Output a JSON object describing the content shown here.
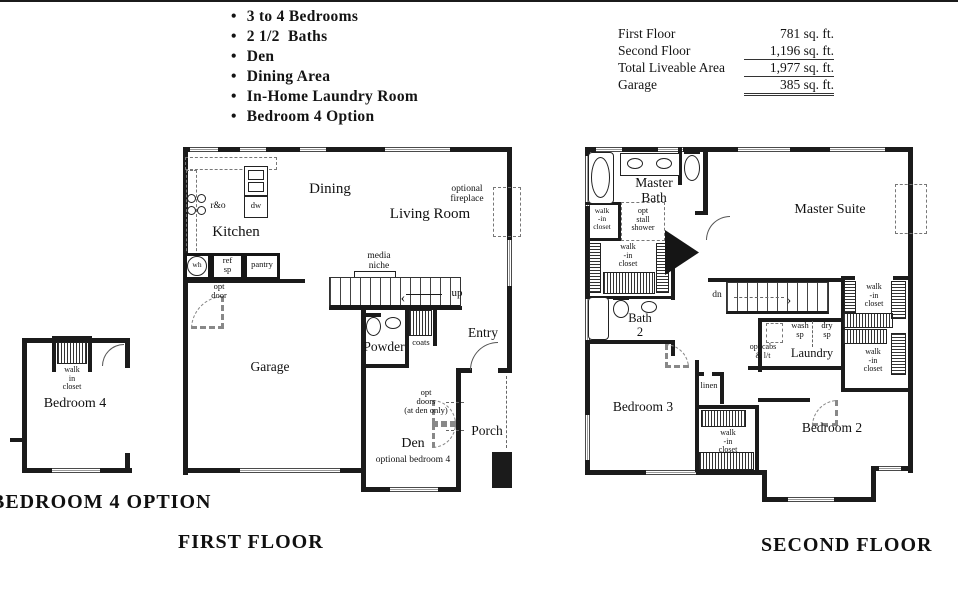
{
  "features": {
    "items": [
      "3 to 4 Bedrooms",
      "2 1/2  Baths",
      "Den",
      "Dining Area",
      "In-Home Laundry Room",
      "Bedroom 4 Option"
    ]
  },
  "area_table": {
    "rows": [
      {
        "label": "First Floor",
        "value": "781 sq. ft."
      },
      {
        "label": "Second Floor",
        "value": "1,196 sq. ft."
      },
      {
        "label": "Total Liveable Area",
        "value": "1,977 sq. ft."
      },
      {
        "label": "Garage",
        "value": "385 sq. ft."
      }
    ]
  },
  "first_floor": {
    "caption": "FIRST FLOOR",
    "labels": {
      "kitchen": "Kitchen",
      "dining": "Dining",
      "living_room": "Living Room",
      "optional_fireplace": "optional\nfireplace",
      "media_niche": "media\nniche",
      "up": "up",
      "powder": "Powder",
      "coats": "coats",
      "entry": "Entry",
      "garage": "Garage",
      "opt_door": "opt\ndoor",
      "opt_doors": "opt\ndoors\n(at den only)",
      "den": "Den",
      "den_sub": "optional bedroom 4",
      "porch": "Porch",
      "r_and_o": "r&o",
      "dw": "dw",
      "wh": "wh",
      "ref_sp": "ref\nsp",
      "pantry": "pantry"
    }
  },
  "bedroom4_option": {
    "caption": "BEDROOM 4 OPTION",
    "labels": {
      "room": "Bedroom 4",
      "closet": "walk\nin\ncloset"
    }
  },
  "second_floor": {
    "caption": "SECOND FLOOR",
    "labels": {
      "master_bath": "Master\nBath",
      "master_suite": "Master Suite",
      "opt_stall_shower": "opt\nstall\nshower",
      "walk_in_closet": "walk\n-in\ncloset",
      "bath_2": "Bath\n2",
      "dn": "dn",
      "wash_sp": "wash\nsp",
      "dry_sp": "dry\nsp",
      "opt_cabs": "opt cabs\n& l/t",
      "laundry": "Laundry",
      "linen": "linen",
      "bedroom_2": "Bedroom 2",
      "bedroom_3": "Bedroom 3"
    }
  }
}
